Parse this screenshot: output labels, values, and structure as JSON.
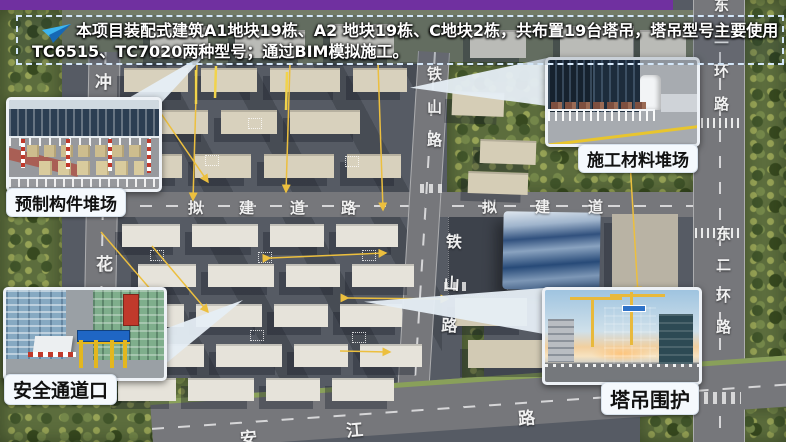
{
  "header": {
    "line1": "本项目装配式建筑A1地块19栋、A2 地块19栋、C地块2栋，共布置19台塔吊，塔吊型号主要使用",
    "line2": "TC6515、TC7020两种型号；通过BIM模拟施工。"
  },
  "callouts": {
    "precast": {
      "label": "预制构件堆场"
    },
    "safety": {
      "label": "安全通道口"
    },
    "material": {
      "label": "施工材料堆场"
    },
    "crane": {
      "label": "塔吊围护"
    }
  },
  "roads": {
    "tieshan_upper": "铁山路",
    "tieshan_lower": "铁山路",
    "proposed_left": "拟建道路",
    "proposed_right": "拟建道",
    "left_road_chars": [
      "冲",
      "花"
    ],
    "east_ring_upper": "东二环路",
    "east_ring_lower": "东二环路",
    "bottom_road_chars": [
      "安",
      "江",
      "路"
    ]
  },
  "colors": {
    "purple_bar": "#7030a0",
    "leader_line_yellow": "#ecbf3e",
    "header_text": "#ffffff",
    "label_bg": "#f5f9fd",
    "label_text": "#111111"
  }
}
